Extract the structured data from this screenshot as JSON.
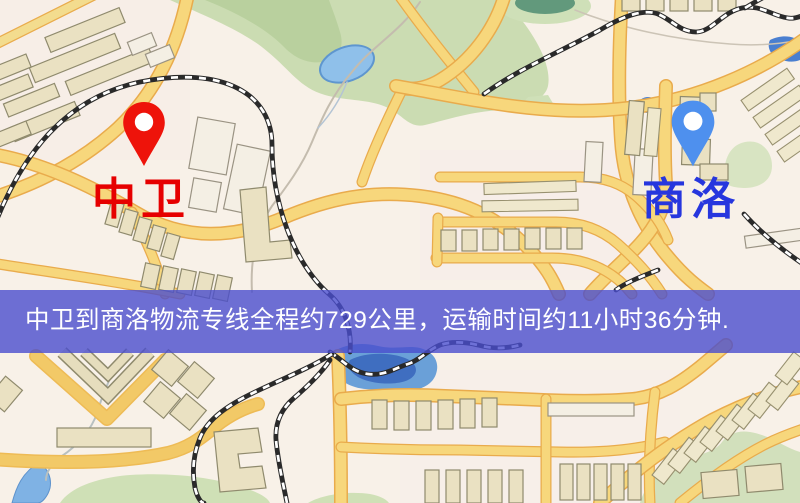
{
  "banner": {
    "text": "中卫到商洛物流专线全程约729公里，运输时间约11小时36分钟.",
    "bg_color": "#4a4ecd",
    "text_color": "#ffffff"
  },
  "markers": {
    "origin": {
      "label": "中卫",
      "label_color": "#e60000",
      "pin_color": "#ee130a",
      "icon": "map-pin"
    },
    "destination": {
      "label": "商洛",
      "label_color": "#2636de",
      "pin_color": "#4e90ee",
      "icon": "map-pin"
    }
  },
  "map": {
    "palette": {
      "background": "#f8f1e8",
      "road_fill": "#f7d77c",
      "road_casing": "#e9ab4c",
      "building_fill": "#eae1c2",
      "building_stroke": "#8f8a6d",
      "park_green": "#cbdcb2",
      "water_blue": "#7fb2e4",
      "railway_black": "#2a2a2a"
    }
  }
}
